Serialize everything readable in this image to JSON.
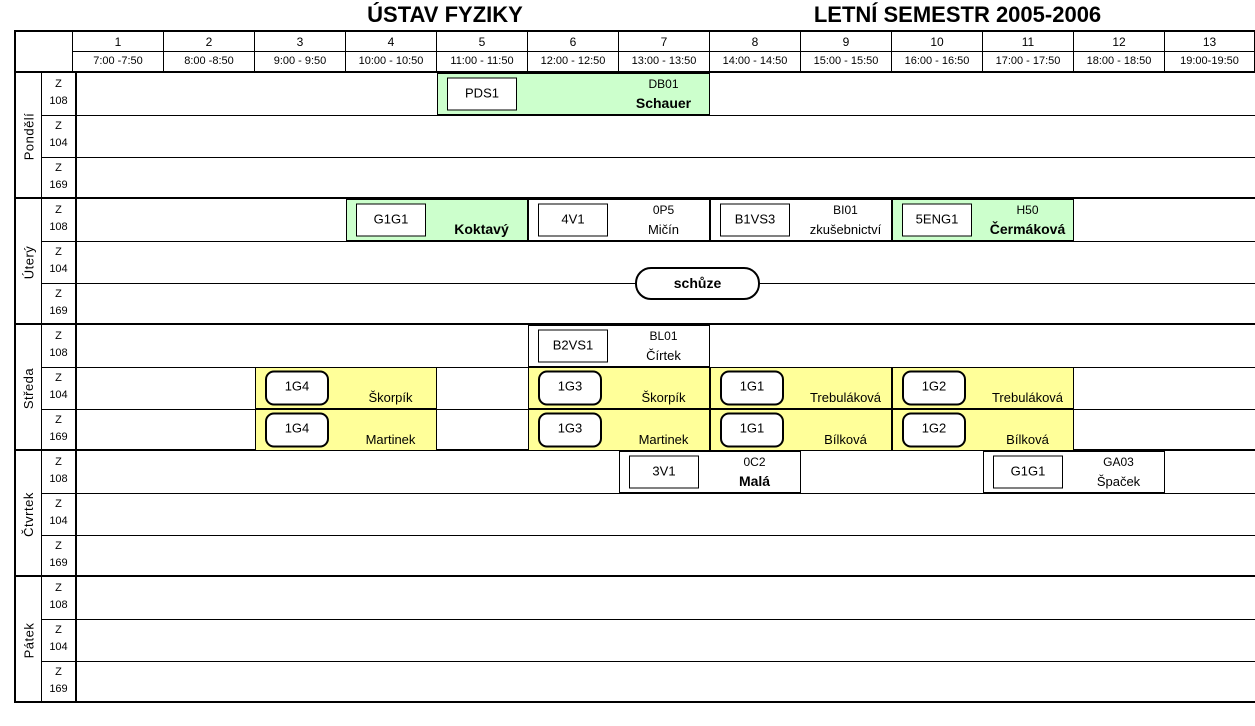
{
  "title": {
    "left": "ÚSTAV FYZIKY",
    "right": "LETNÍ SEMESTR  2005-2006"
  },
  "colors": {
    "green": "#ccffcc",
    "yellow": "#ffff99",
    "white": "#ffffff"
  },
  "header": {
    "slots": [
      {
        "num": "1",
        "time": "7:00 -7:50"
      },
      {
        "num": "2",
        "time": "8:00 -8:50"
      },
      {
        "num": "3",
        "time": "9:00 - 9:50"
      },
      {
        "num": "4",
        "time": "10:00 - 10:50"
      },
      {
        "num": "5",
        "time": "11:00 - 11:50"
      },
      {
        "num": "6",
        "time": "12:00 - 12:50"
      },
      {
        "num": "7",
        "time": "13:00 - 13:50"
      },
      {
        "num": "8",
        "time": "14:00 - 14:50"
      },
      {
        "num": "9",
        "time": "15:00 - 15:50"
      },
      {
        "num": "10",
        "time": "16:00 - 16:50"
      },
      {
        "num": "11",
        "time": "17:00 - 17:50"
      },
      {
        "num": "12",
        "time": "18:00 - 18:50"
      },
      {
        "num": "13",
        "time": "19:00-19:50"
      }
    ]
  },
  "days": [
    {
      "name": "Pondělí"
    },
    {
      "name": "Úterý"
    },
    {
      "name": "Středa"
    },
    {
      "name": "Čtvrtek"
    },
    {
      "name": "Pátek"
    }
  ],
  "rooms": [
    {
      "l1": "Z",
      "l2": "108"
    },
    {
      "l1": "Z",
      "l2": "104"
    },
    {
      "l1": "Z",
      "l2": "169"
    }
  ],
  "overlay": {
    "label": "schůze"
  },
  "events": [
    {
      "day": 0,
      "room": 0,
      "startCol": 5,
      "endCol": 7,
      "bg": "green",
      "boxStyle": "sq",
      "box": "PDS1",
      "code": "DB01",
      "name": "Schauer",
      "nameBold": true
    },
    {
      "day": 1,
      "room": 0,
      "startCol": 4,
      "endCol": 5,
      "bg": "green",
      "boxStyle": "sq",
      "box": "G1G1",
      "code": "",
      "name": "Koktavý",
      "nameBold": true
    },
    {
      "day": 1,
      "room": 0,
      "startCol": 6,
      "endCol": 7,
      "bg": "white",
      "boxStyle": "sq",
      "box": "4V1",
      "code": "0P5",
      "name": "Mičín",
      "nameBold": false
    },
    {
      "day": 1,
      "room": 0,
      "startCol": 8,
      "endCol": 9,
      "bg": "white",
      "boxStyle": "sq",
      "box": "B1VS3",
      "code": "BI01",
      "name": "zkušebnictví",
      "nameBold": false
    },
    {
      "day": 1,
      "room": 0,
      "startCol": 10,
      "endCol": 11,
      "bg": "green",
      "boxStyle": "sq",
      "box": "5ENG1",
      "code": "H50",
      "name": "Čermáková",
      "nameBold": true
    },
    {
      "day": 2,
      "room": 0,
      "startCol": 6,
      "endCol": 7,
      "bg": "white",
      "boxStyle": "sq",
      "box": "B2VS1",
      "code": "BL01",
      "name": "Čírtek",
      "nameBold": false
    },
    {
      "day": 2,
      "room": 1,
      "startCol": 3,
      "endCol": 4,
      "bg": "yellow",
      "boxStyle": "rd",
      "box": "1G4",
      "code": "",
      "name": "Škorpík",
      "nameBold": false
    },
    {
      "day": 2,
      "room": 1,
      "startCol": 6,
      "endCol": 7,
      "bg": "yellow",
      "boxStyle": "rd",
      "box": "1G3",
      "code": "",
      "name": "Škorpík",
      "nameBold": false
    },
    {
      "day": 2,
      "room": 1,
      "startCol": 8,
      "endCol": 9,
      "bg": "yellow",
      "boxStyle": "rd",
      "box": "1G1",
      "code": "",
      "name": "Trebuláková",
      "nameBold": false
    },
    {
      "day": 2,
      "room": 1,
      "startCol": 10,
      "endCol": 11,
      "bg": "yellow",
      "boxStyle": "rd",
      "box": "1G2",
      "code": "",
      "name": "Trebuláková",
      "nameBold": false
    },
    {
      "day": 2,
      "room": 2,
      "startCol": 3,
      "endCol": 4,
      "bg": "yellow",
      "boxStyle": "rd",
      "box": "1G4",
      "code": "",
      "name": "Martinek",
      "nameBold": false
    },
    {
      "day": 2,
      "room": 2,
      "startCol": 6,
      "endCol": 7,
      "bg": "yellow",
      "boxStyle": "rd",
      "box": "1G3",
      "code": "",
      "name": "Martinek",
      "nameBold": false
    },
    {
      "day": 2,
      "room": 2,
      "startCol": 8,
      "endCol": 9,
      "bg": "yellow",
      "boxStyle": "rd",
      "box": "1G1",
      "code": "",
      "name": "Bílková",
      "nameBold": false
    },
    {
      "day": 2,
      "room": 2,
      "startCol": 10,
      "endCol": 11,
      "bg": "yellow",
      "boxStyle": "rd",
      "box": "1G2",
      "code": "",
      "name": "Bílková",
      "nameBold": false
    },
    {
      "day": 3,
      "room": 0,
      "startCol": 7,
      "endCol": 8,
      "bg": "white",
      "boxStyle": "sq",
      "box": "3V1",
      "code": "0C2",
      "name": "Malá",
      "nameBold": true
    },
    {
      "day": 3,
      "room": 0,
      "startCol": 11,
      "endCol": 12,
      "bg": "white",
      "boxStyle": "sq",
      "box": "G1G1",
      "code": "GA03",
      "name": "Špaček",
      "nameBold": false
    }
  ]
}
